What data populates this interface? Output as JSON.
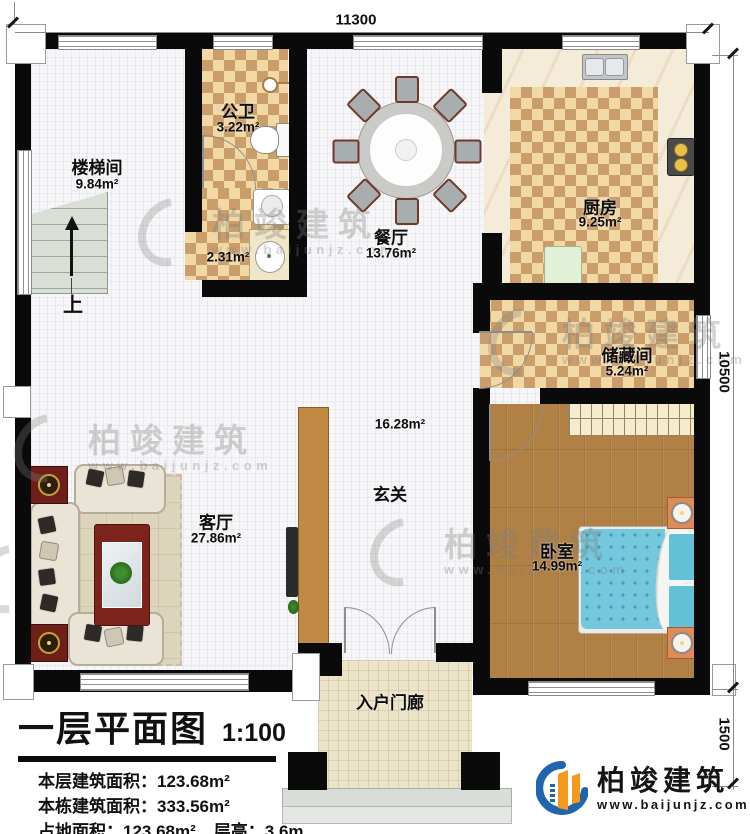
{
  "title_block": {
    "title": "一层平面图",
    "scale": "1:100",
    "stats": {
      "line1_label": "本层建筑面积：",
      "line1_value": "123.68m²",
      "line2_label": "本栋建筑面积：",
      "line2_value": "333.56m²",
      "line3a_label": "占地面积：",
      "line3a_value": "123.68m²",
      "line3b_label": "层高：",
      "line3b_value": "3.6m"
    }
  },
  "rooms": {
    "stairwell": {
      "name": "楼梯间",
      "area": "9.84m²"
    },
    "bath": {
      "name": "公卫",
      "area": "3.22m²"
    },
    "bath_lobby": {
      "area": "2.31m²"
    },
    "dining": {
      "name": "餐厅",
      "area": "13.76m²"
    },
    "kitchen": {
      "name": "厨房",
      "area": "9.25m²"
    },
    "storage": {
      "name": "储藏间",
      "area": "5.24m²"
    },
    "foyer": {
      "name": "玄关",
      "area": "16.28m²"
    },
    "living": {
      "name": "客厅",
      "area": "27.86m²"
    },
    "bedroom": {
      "name": "卧室",
      "area": "14.99m²"
    },
    "porch": {
      "name": "入户门廊"
    }
  },
  "dimensions": {
    "width": "11300",
    "height": "10500",
    "porch_depth": "1500"
  },
  "annotations": {
    "stairs_up": "上"
  },
  "brand": {
    "name": "柏竣建筑",
    "url": "www.baijunjz.com"
  },
  "colors": {
    "wall": "#0a0a0a",
    "checker_dark": "#c99e6b",
    "wood": "#b08044",
    "bed": "#74c7dd",
    "brand_blue": "#1f66ad",
    "brand_orange": "#f59a1d"
  }
}
